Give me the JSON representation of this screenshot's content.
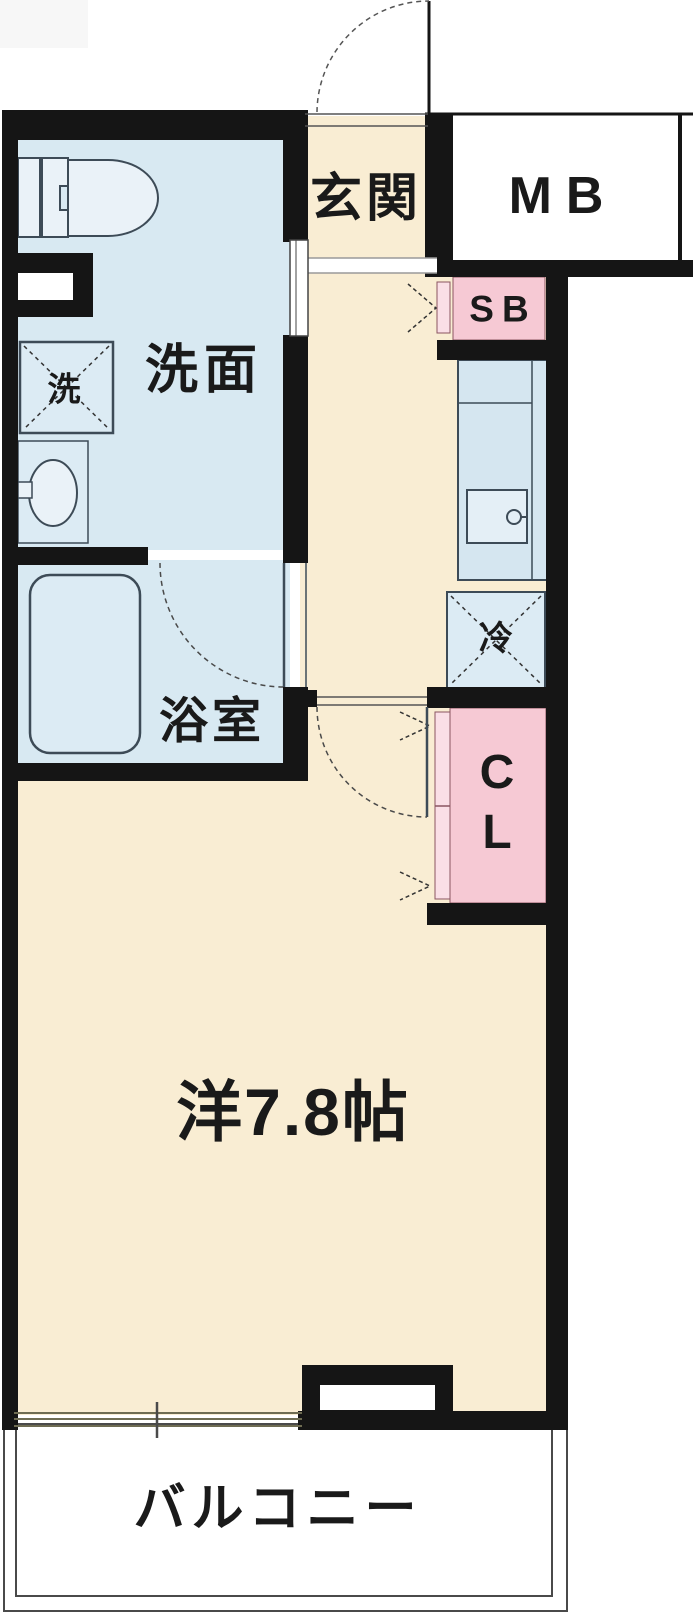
{
  "floorplan": {
    "type": "apartment-floor-plan",
    "labels": {
      "entrance": "玄関",
      "meter_box": "MB",
      "shoe_box": "SB",
      "washroom": "洗面",
      "washing_machine": "洗",
      "bathroom": "浴室",
      "refrigerator": "冷",
      "closet_line1": "C",
      "closet_line2": "L",
      "main_room": "洋7.8帖",
      "balcony": "バルコニー"
    },
    "colors": {
      "wall": "#151515",
      "room_beige": "#f9edd3",
      "wet_area_blue": "#d8e9f2",
      "fixture_fill": "#e7f0f7",
      "counter_blue": "#d5e6f0",
      "pink": "#f6c9d4",
      "pink_light": "#fadfe6",
      "fixture_line": "#3d4b57",
      "window_line": "#6e6c52",
      "text": "#1a1a1a"
    }
  }
}
